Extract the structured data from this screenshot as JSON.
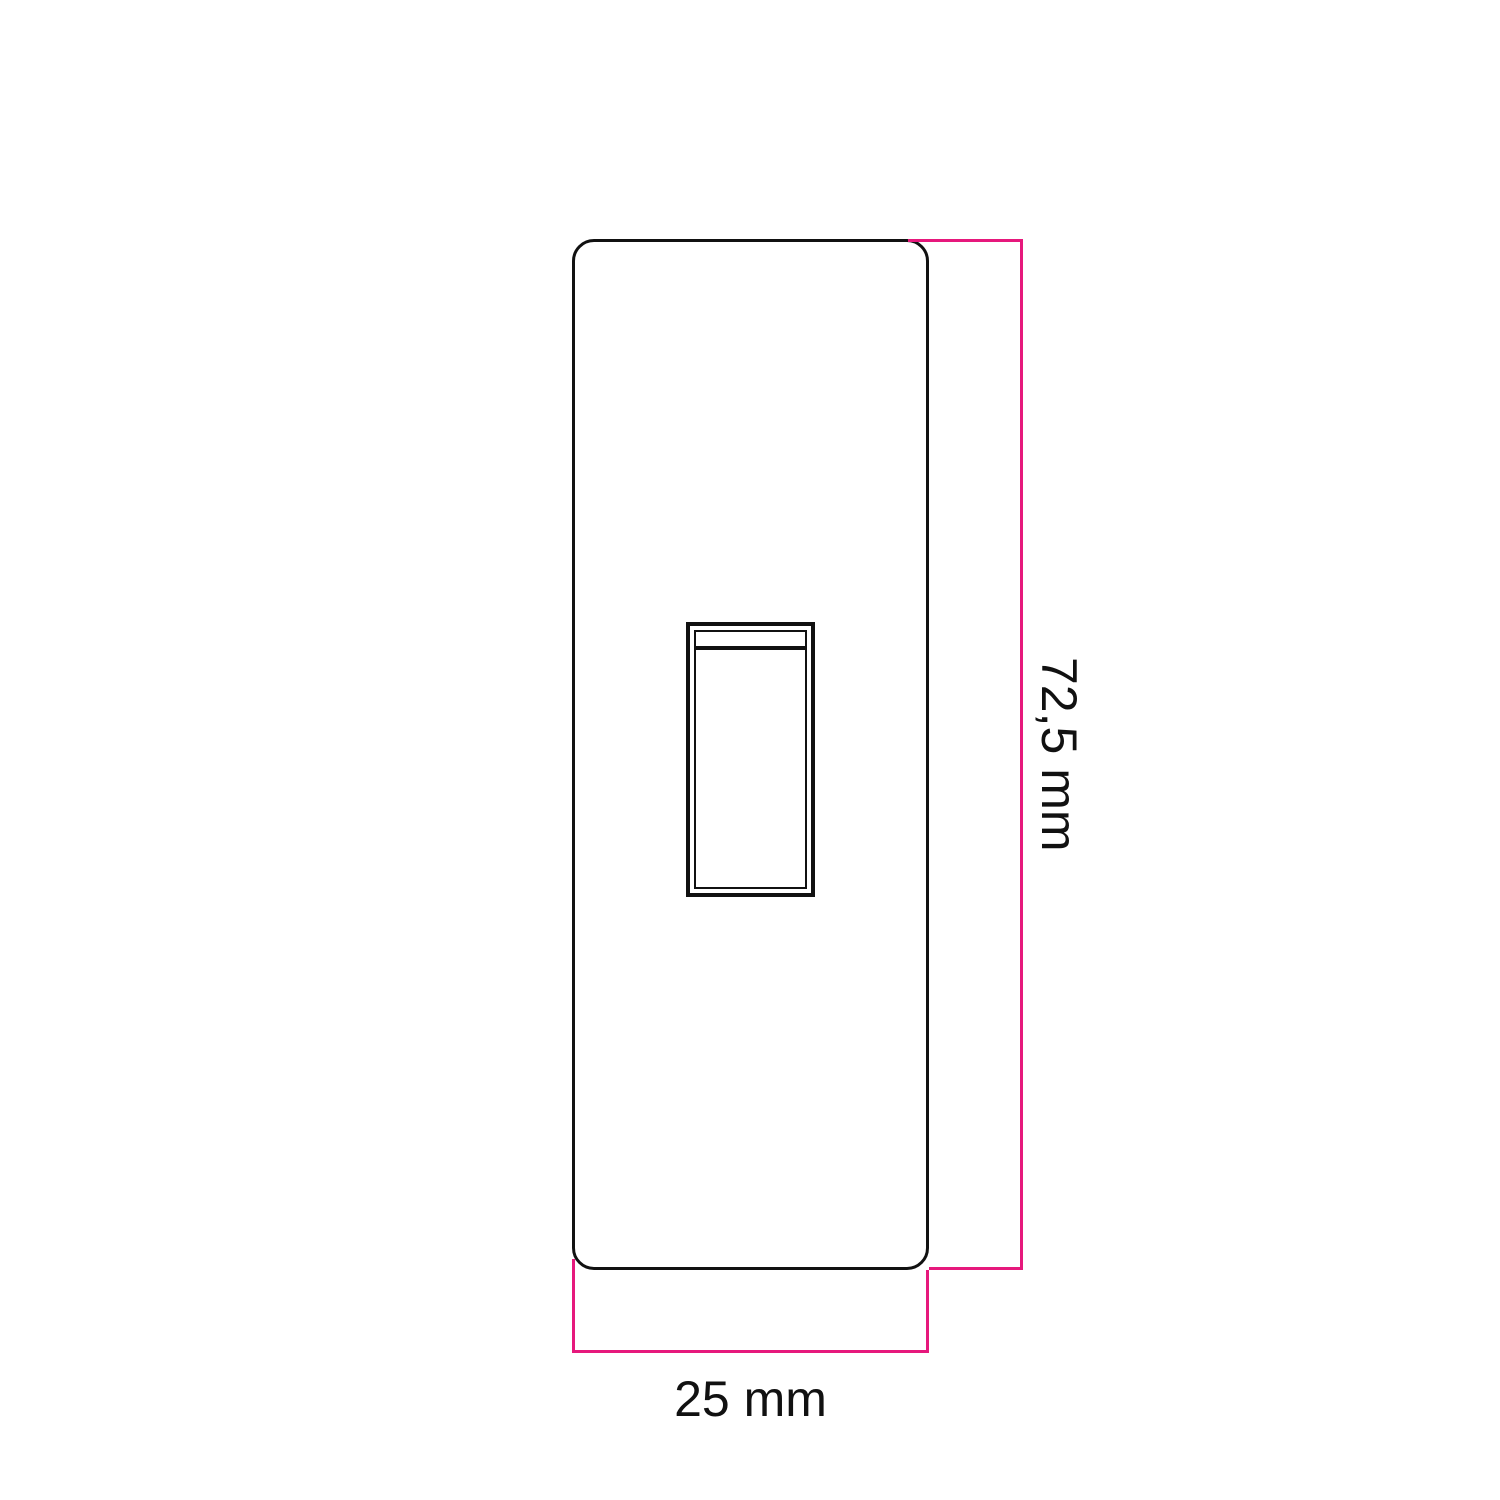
{
  "diagram": {
    "title": "switch-plate-dimension-drawing",
    "subject": "rocker-switch-cover-plate-front-view",
    "height_label": "72,5 mm",
    "width_label": "25 mm",
    "colors": {
      "outline": "#111111",
      "dimension_line": "#e6187c",
      "background": "#ffffff"
    }
  }
}
